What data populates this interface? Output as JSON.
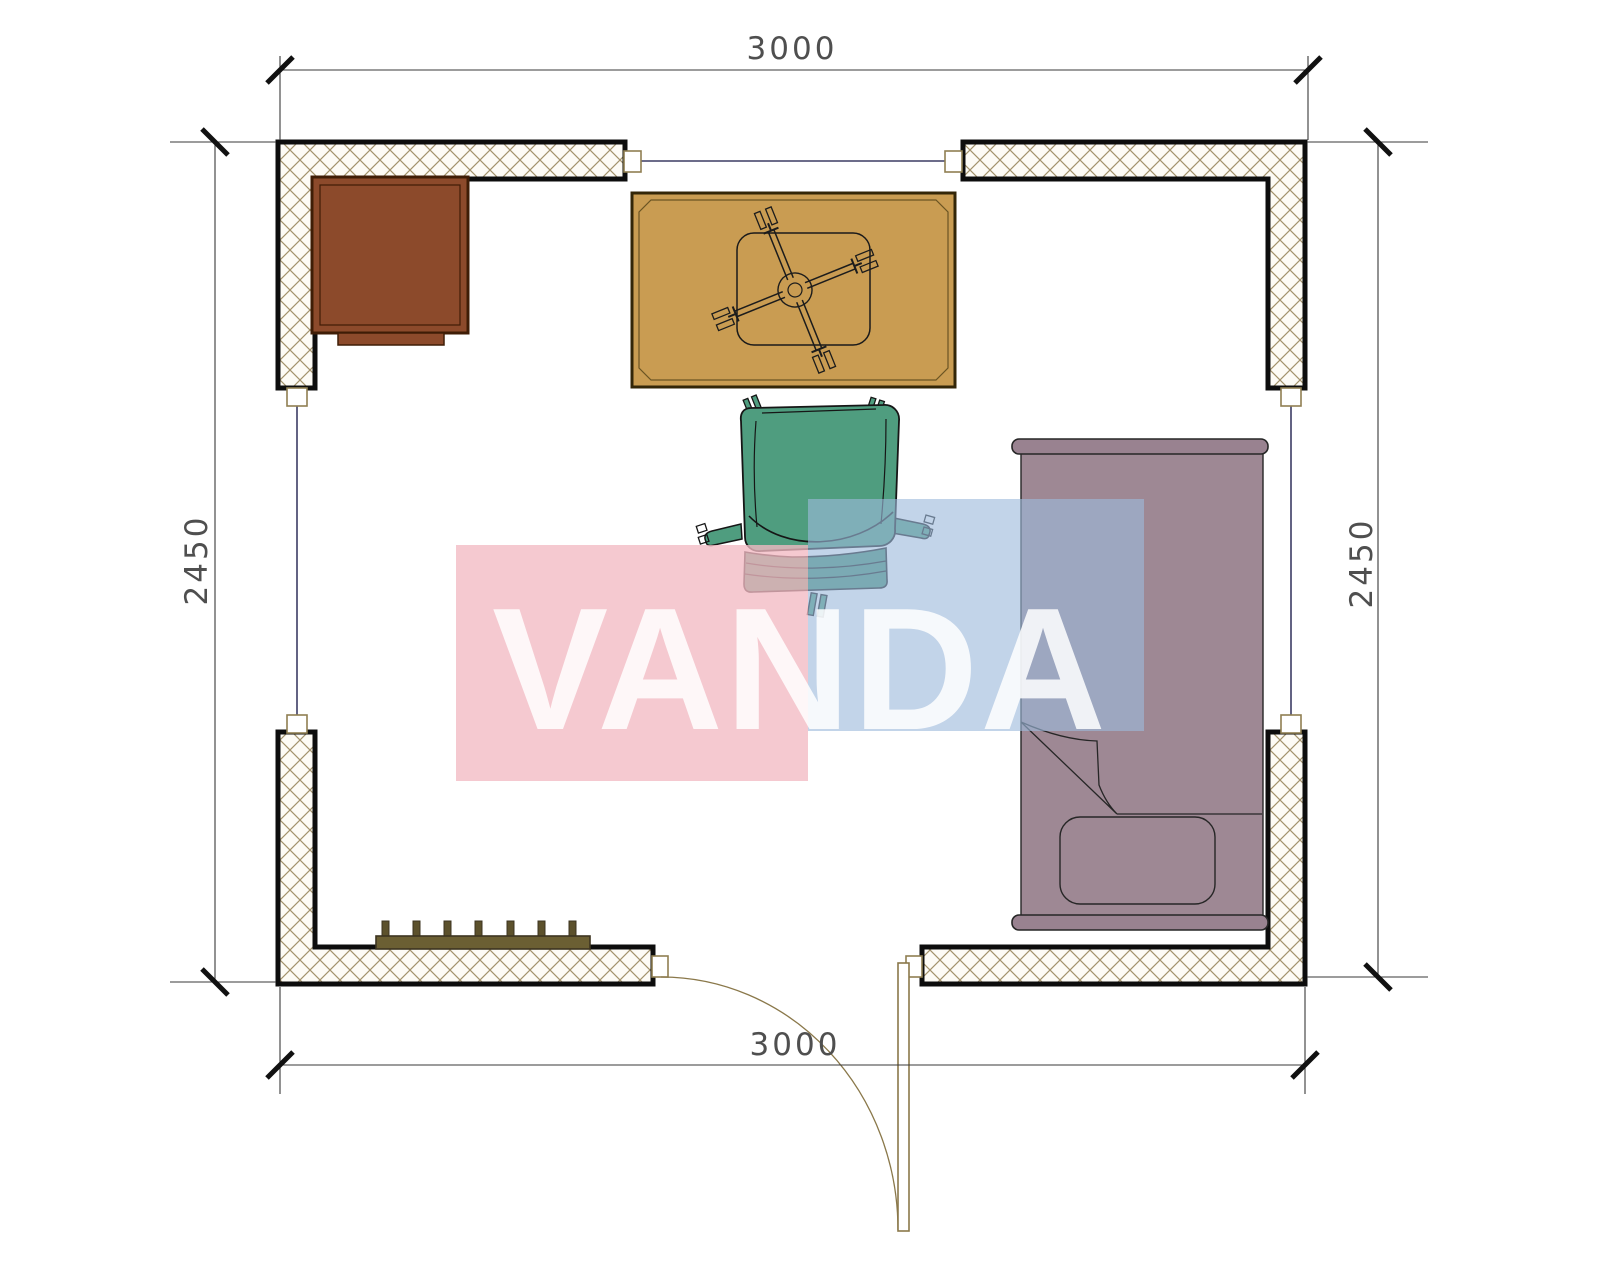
{
  "dimensions": {
    "top": "3000",
    "bottom": "3000",
    "left": "2450",
    "right": "2450"
  },
  "watermark": {
    "text": "VANDA",
    "pink_block_color": "rgba(242,186,195,0.78)",
    "blue_block_color": "rgba(157,186,219,0.62)",
    "text_color": "rgba(255,255,255,0.85)"
  },
  "colors": {
    "wall_border": "#0d0d0d",
    "wall_hatch": "#a3926c",
    "cap_outline": "#8f7f52",
    "window_line": "#3c3c64",
    "cabinet": "#8c4a2b",
    "cabinet_border": "#3f1d06",
    "desk": "#c99c52",
    "desk_border": "#332608",
    "chair": "#4f9d7f",
    "chair_skirt": "#459073",
    "bed": "#9e8894",
    "bed_frame": "#998290",
    "radiator": "#6b5f33",
    "radiator_border": "#3c3420",
    "door": "#8a784a",
    "dimension_line": "#3a3a3a",
    "dimension_text": "#4f4f4f"
  },
  "furniture": [
    {
      "name": "cabinet"
    },
    {
      "name": "desk-with-chair-base"
    },
    {
      "name": "office-chair"
    },
    {
      "name": "bed"
    },
    {
      "name": "radiator"
    },
    {
      "name": "door"
    }
  ]
}
